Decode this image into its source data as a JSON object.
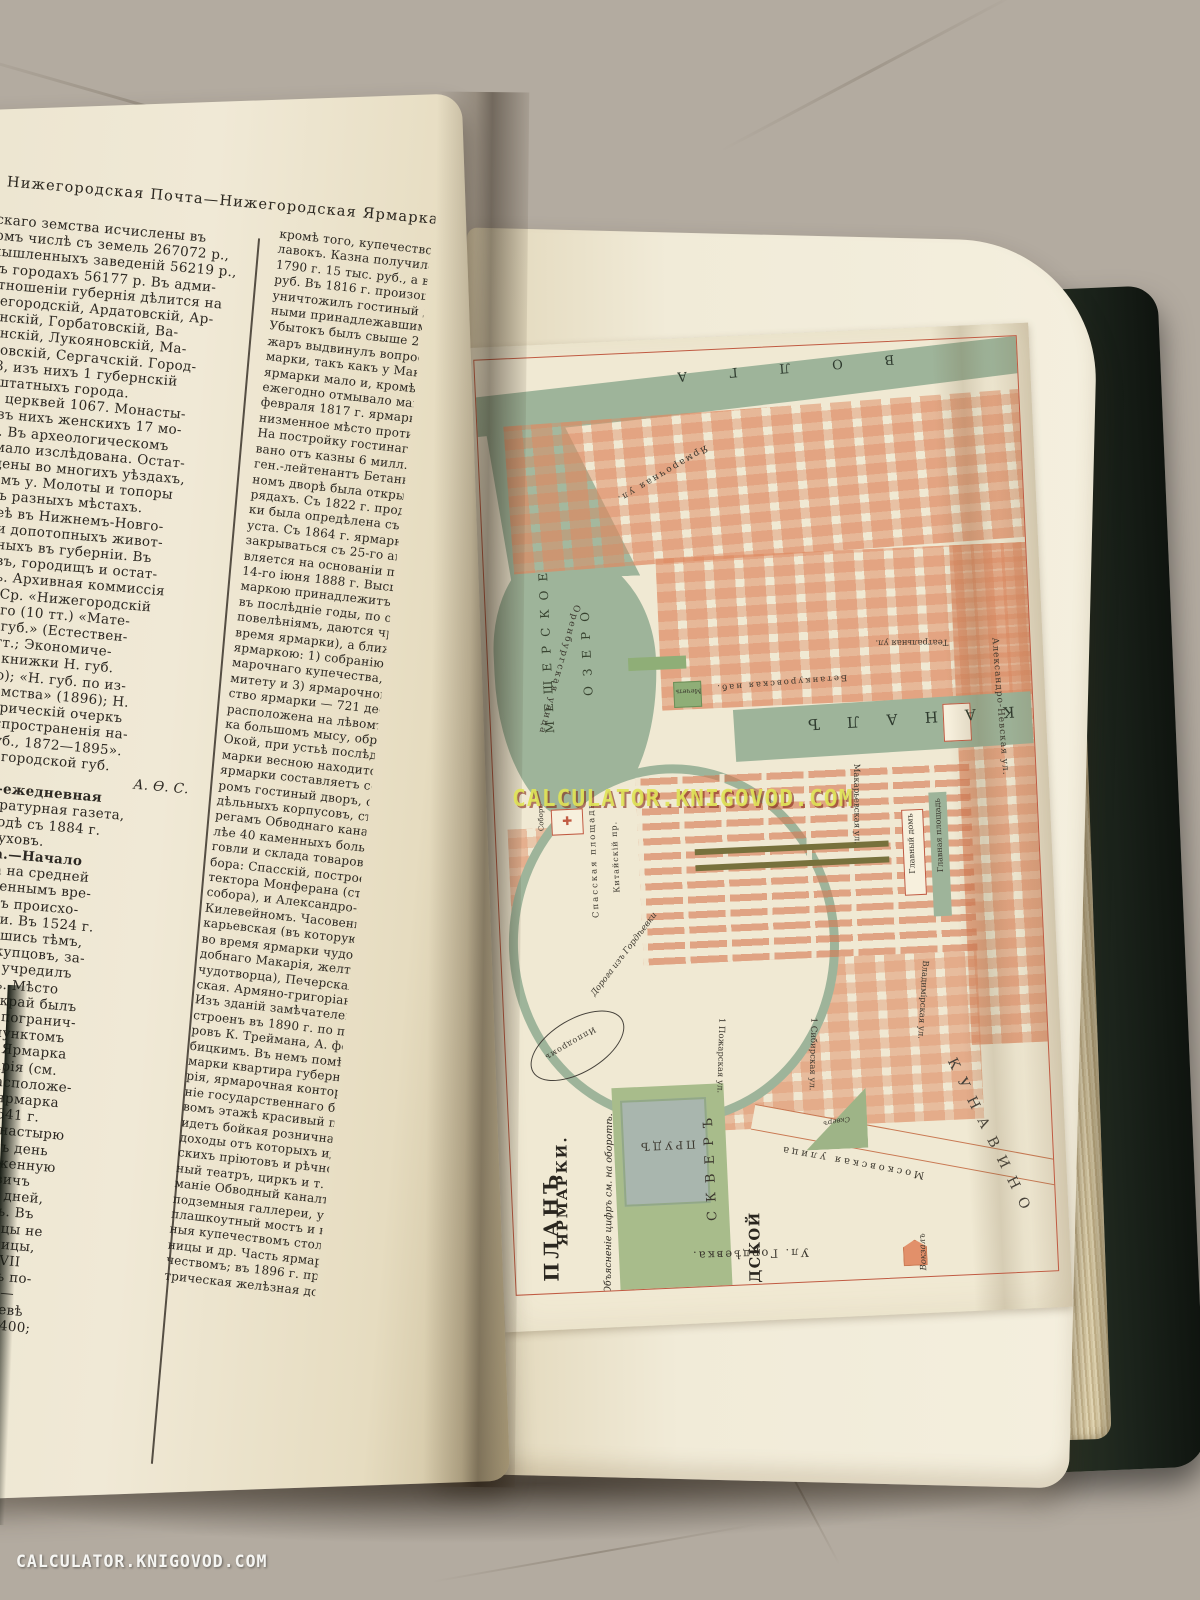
{
  "watermark": {
    "text": "CALCULATOR.KNIGOVOD.COM"
  },
  "left_page": {
    "running_header": "Нижегородская Почта—Нижегородская Ярмарка",
    "col1_lines": [
      "губернскаго земства исчислены въ",
      "о., въ томъ числѣ съ земель 267072 р.,",
      "во-промышленныхъ заведеній 56219 р.,",
      "ествъ, въ городахъ 56177 р. Въ адми-",
      "зномъ отношеніи губернія дѣлится на",
      "ъ.—Нижегородскій, Ардатовскій, Ар-",
      "Балахнинскій, Горбатовскій, Ва-",
      "Княгининскій, Лукояновскій, Ма-",
      "й, Семеновскій, Сергачскій. Город-",
      "еленій 13, изъ нихъ 1 губернскій",
      "хъ и 2 заштатныхъ города.",
      "49. Всѣхъ церквей 1067. Монасты-",
      "инъ 25; изъ нихъ женскихъ 17 мо-",
      "и общинъ. Въ археологическомъ",
      "губернія мало изслѣдована. Остат-",
      "были найдены во многихъ уѣздахъ,",
      "Сергачскомъ у. Молоты и топоры",
      "найдены въ разныхъ мѣстахъ.",
      "скомъ музеѣ въ Нижнемъ-Новго-",
      "тся остатки допотопныхъ живот-",
      "тъ, найденныхъ въ губерніи. Въ",
      "го кургановъ, городищъ и остат-",
      "ковъ валовъ. Архивная коммиссія",
      "«Трудовъ». Ср. «Нижегородскій",
      "С. Гацисскаго (10 тт.) «Мате-",
      "ѣ земель Н. губ.» (Естествен-",
      "я часть, 14 тт.; Экономиче-",
      "); памятныя книжки Н. губ.",
      "ключительно); «Н. губ. по из-",
      "бернскаго земства» (1896); Н.",
      "Краткій историческій очеркъ",
      "общества распространенія на-",
      "ванія въ Н. губ., 1872—1895».",
      "а карта Нижегородской губ.",
      "А. Ѳ. С.",
      "ская Почта—ежедневная",
      "венная и литературная газета,",
      "кнемъ-Новгородѣ съ 1884 г.",
      "ель В. Н. Пастуховъ.",
      "ская ярмарка.—Начало",
      "ическаго торга на средней",
      "къ очень отдаленнымъ вре-",
      "овинѣ XIII в. онъ происхо-",
      "полѣ, ок. Казани. Въ 1524 г.",
      "ъ, воспользовавшись тѣмъ,",
      "били русскихъ купцовъ, за-",
      "ить въ Казань и учредилъ",
      "въ Васильсурскѣ. Мѣсто",
      "ачно, такъ какъ край былъ",
      "ильсурскъ, какъ погранич-",
      "илъ исходнымъ пунктомъ",
      "противъ Казани. Ярмарка",
      "обители св. Макарія (см.",
      "аря выгодному расположе-",
      "волжскаго пути, ярмарка",
      "лѣе и болѣе. Въ 1641 г.",
      "доровичъ далъ монастырю",
      "орговцевъ за одинъ день",
      "св. Макарія) таможенную",
      "Алексѣй Михайловичъ",
      "безпошлинно пять дней,",
      "тить особый налогъ. Въ",
      "пріѣзжали уже купцы не",
      "іи, но и изъ-за границы,",
      "недѣли. Въ концѣ XVII",
      "остигалъ 80 тыс., въ по-",
      "тыс., а къ концу его—",
      "то время въ Макарьевѣ",
      "ъ помѣщеній было 1400;"
    ],
    "col2_lines": [
      "кромѣ того, купечествомъ бы",
      "лавокъ. Казна получила отъ",
      "1790 г. 15 тыс. руб., а въ 18",
      "руб. Въ 1816 г. произошелъ",
      "уничтожилъ гостиный дворъ",
      "ными принадлежавшими къ н",
      "Убытокъ былъ свыше 2 мил.",
      "жаръ выдвинулъ вопросъ о",
      "марки, такъ какъ у Макарья",
      "ярмарки мало и, кромѣ того,",
      "ежегодно отмывало макарьевс",
      "февраля 1817 г. ярмарка бы",
      "низменное мѣсто противъ Ниж",
      "На постройку гостинаго двор",
      "вано отъ казны 6 милл. руб. Ст",
      "ген.-лейтенантъ Бетанкуръ. Въ",
      "номъ дворѣ была открыта торг",
      "рядахъ. Съ 1822 г. продолжит",
      "ки была опредѣлена съ 15-го",
      "уста. Съ 1864 г. ярмарка оф",
      "закрываться съ 25-го августа.",
      "вляется на основаніи правилъ",
      "14-го іюня 1888 г. Высшее н",
      "маркою принадлежитъ губерн",
      "въ послѣдніе годы, по особым",
      "повелѣніямъ, даются чрезвыч",
      "время ярмарки), а ближайше",
      "ярмаркою: 1) собранію уполн",
      "марочнаго купечества, 2) ярм",
      "митету и 3) ярмарочной конт",
      "ство ярмарки — 721 дес. 725",
      "расположена на лѣвомъ, луго",
      "ка большомъ мысу, образуемо",
      "Окой, при устьѣ послѣдней. Бо",
      "марки весною находится подъ",
      "ярмарки составляетъ сооруж",
      "ромъ гостиный дворъ, состоя",
      "дѣльныхъ корпусовъ, съ 2530",
      "регамъ Обводнаго канала выс",
      "лѣе 40 каменныхъ большихъ",
      "говли и склада товаровъ. На",
      "бора: Спасскій, построенный",
      "тектора Монферана (строите",
      "собора), и Александро-Невскі",
      "Килевейномъ. Часовень на",
      "карьевская (въ которую еже",
      "во время ярмарки чудотворн",
      "добнаго Макарія, желтоводск",
      "чудотворца), Печерская и Кр",
      "ская. Армяно-григоріанская ц",
      "Изъ зданій замѣчателенъ гла",
      "строенъ въ 1890 г. по проек",
      "ровъ К. Треймана, А. фонъ-Га",
      "бицкимъ. Въ немъ помѣщае",
      "марки квартира губернатора",
      "рія, ярмарочная контора и ко",
      "ніе государственнаго банка и",
      "вомъ этажѣ красивый пассаж",
      "идетъ бойкая розничная торг",
      "доходы отъ которыхъ идутъ",
      "скихъ пріютовъ и рѣчного уч",
      "ный театръ, циркъ и т. д. З",
      "маніе Обводный каналъ (400",
      "подземныя галлереи, устроен",
      "плашкоутный мостъ и водопр",
      "ныя купечествомъ столовыя и",
      "ницы и др. Часть ярмарки ос",
      "чествомъ; въ 1896 г. провед",
      "трическая желѣзная дорога. В"
    ]
  },
  "map": {
    "title_line1": "ПЛАНЪ",
    "title_line2": "НИЖЕГОРОДСКОЙ",
    "title_line3": "ЯРМАРКИ.",
    "note": "Объясненіе цифръ см. на оборотѣ.",
    "labels": {
      "river": "ВОЛГА",
      "lake_line1": "МЕЩЕРСКОЕ",
      "lake_line2": "ОЗЕРО",
      "canal": "КАНАЛЪ",
      "pond": "ПРУДЪ",
      "big_square": "СКВЕРЪ",
      "small_square": "Скверъ",
      "mosque": "Мечеть",
      "cathedral": "Соборъ",
      "spasskaya_sq": "Спасская площадь",
      "kitaysky": "Китайскій пр.",
      "main_house": "Главный домъ",
      "main_square": "Главная площадь",
      "st_orenburg": "Оренбургская улица",
      "st_yarmarka": "Ярмарочная ул.",
      "st_betankur": "Бетанкуровская наб.",
      "st_theatre": "Театральная ул.",
      "st_makar": "Макарьевская ул.",
      "st_alexnev": "Александро-Невская ул.",
      "st_pozhar": "1 Пожарская ул.",
      "st_sibir": "1 Сибирская ул.",
      "st_vladimir": "Владимірская ул.",
      "st_moscow": "Московская улица",
      "gordeevka": "Ул. Гордѣевка.",
      "station": "Вокзалъ",
      "hippodrome": "Ипподромъ",
      "road_note": "Дорога изъ Гордѣевки",
      "kunavino": "КУНАВИНО"
    }
  },
  "colors": {
    "map_green": "#9eb49a",
    "map_building": "#e2906a",
    "map_paper": "#f0e9d3",
    "frame_red": "#c05a42",
    "pond_blue": "#a9b6ae",
    "cover_green": "#1d2419",
    "page_cream": "#efe9d6",
    "watermark_yellow": "#dee255"
  }
}
